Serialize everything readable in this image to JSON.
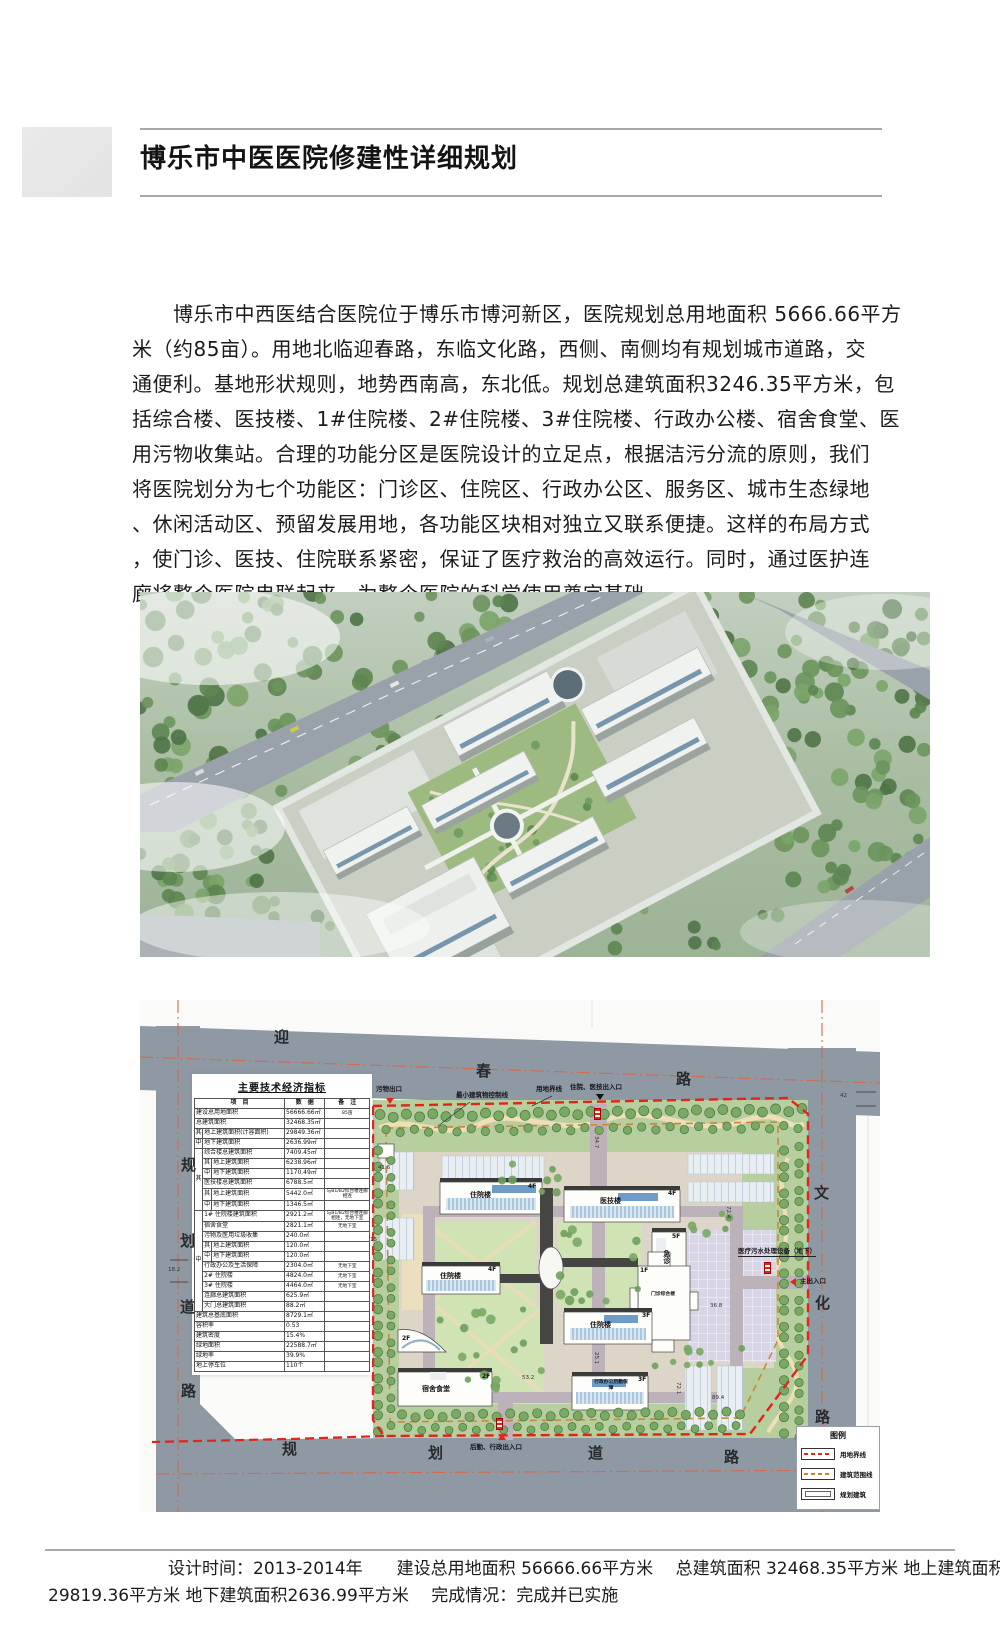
{
  "page": {
    "title": "博乐市中医医院修建性详细规划",
    "intro_lines": [
      "　　博乐市中西医结合医院位于博乐市博河新区，医院规划总用地面积 5666.66平方",
      "米（约85亩）。用地北临迎春路，东临文化路，西侧、南侧均有规划城市道路，交",
      "通便利。基地形状规则，地势西南高，东北低。规划总建筑面积3246.35平方米，包",
      "括综合楼、医技楼、1#住院楼、2#住院楼、3#住院楼、行政办公楼、宿舍食堂、医",
      "用污物收集站。合理的功能分区是医院设计的立足点，根据洁污分流的原则，我们",
      "将医院划分为七个功能区：门诊区、住院区、行政办公区、服务区、城市生态绿地",
      "、休闲活动区、预留发展用地，各功能区块相对独立又联系便捷。这样的布局方式",
      "，使门诊、医技、住院联系紧密，保证了医疗救治的高效运行。同时，通过医护连",
      "廊将整个医院串联起来，为整个医院的科学使用奠定基础。"
    ],
    "footer_lines": [
      "设计时间：2013-2014年　　建设总用地面积 56666.66平方米　 总建筑面积 32468.35平方米 地上建筑面积",
      "29819.36平方米 地下建筑面积2636.99平方米　 完成情况：完成并已实施"
    ]
  },
  "plan": {
    "roads": {
      "top": [
        "迎",
        "春",
        "路"
      ],
      "right": [
        "文",
        "化",
        "路"
      ],
      "left": [
        "规",
        "划",
        "道",
        "路"
      ],
      "bottom": [
        "规",
        "划",
        "道",
        "路"
      ]
    },
    "buildings": [
      {
        "label": "住院楼",
        "floor": "4F"
      },
      {
        "label": "医技楼",
        "floor": "4F"
      },
      {
        "label": "住院楼",
        "floor": "4F"
      },
      {
        "label": "急诊",
        "floor": "5F"
      },
      {
        "label": "门诊综合楼",
        "floor": "1F"
      },
      {
        "label": "住院楼",
        "floor": "3F"
      },
      {
        "label": "宿舍食堂",
        "floor": "2F"
      },
      {
        "label": "行政办公后勤保障",
        "floor": "3F"
      },
      {
        "label": "",
        "floor": "2F"
      }
    ],
    "annotations": {
      "waste_exit": "污物出口",
      "min_building_control_line": "最小建筑物控制线",
      "land_boundary": "用地界线",
      "inpatient_entrance": "住院、医技出入口",
      "sewage_treatment": "医疗污水处理设备（地下）",
      "main_entrance": "主出入口",
      "logistics_entrance": "后勤、行政出入口"
    },
    "dimensions": [
      "34.7",
      "41.6",
      "15",
      "18.2",
      "25.1",
      "53.2",
      "36.8",
      "72.4",
      "72.1",
      "89.4",
      "42"
    ],
    "legend": {
      "title": "图例",
      "items": [
        {
          "label": "用地界线"
        },
        {
          "label": "建筑范围线"
        },
        {
          "label": "规划建筑"
        }
      ]
    },
    "table": {
      "title": "主要技术经济指标",
      "rows": [
        [
          {
            "t": "项　目",
            "cs": 3
          },
          {
            "t": "数　据"
          },
          {
            "t": "备　注"
          }
        ],
        [
          {
            "t": "建设总用地面积",
            "cs": 3
          },
          {
            "t": "56666.66㎡"
          },
          {
            "t": "85亩"
          }
        ],
        [
          {
            "t": "总建筑面积",
            "cs": 3
          },
          {
            "t": "32468.35㎡"
          },
          {
            "t": ""
          }
        ],
        [
          {
            "t": "其"
          },
          {
            "t": "地上建筑面积(计容面积)",
            "cs": 2
          },
          {
            "t": "29849.36㎡"
          },
          {
            "t": ""
          }
        ],
        [
          {
            "t": "中"
          },
          {
            "t": "地下建筑面积",
            "cs": 2
          },
          {
            "t": "2636.99㎡"
          },
          {
            "t": ""
          }
        ],
        [
          {
            "t": "其",
            "rs": 6
          },
          {
            "t": "综合楼总建筑面积",
            "cs": 2
          },
          {
            "t": "7409.45㎡"
          },
          {
            "t": ""
          }
        ],
        [
          {
            "t": "其"
          },
          {
            "t": "地上建筑面积"
          },
          {
            "t": "6238.96㎡"
          },
          {
            "t": ""
          }
        ],
        [
          {
            "t": "中"
          },
          {
            "t": "地下建筑面积"
          },
          {
            "t": "1170.49㎡"
          },
          {
            "t": ""
          }
        ],
        [
          {
            "t": "医技楼总建筑面积",
            "cs": 2
          },
          {
            "t": "6788.5㎡"
          },
          {
            "t": ""
          }
        ],
        [
          {
            "t": "其"
          },
          {
            "t": "地上建筑面积"
          },
          {
            "t": "5442.0㎡"
          },
          {
            "t": "与B1/B2综合楼连廊相连"
          }
        ],
        [
          {
            "t": "中"
          },
          {
            "t": "地下建筑面积"
          },
          {
            "t": "1346.5㎡"
          },
          {
            "t": ""
          }
        ],
        [
          {
            "t": "中",
            "rs": 10
          },
          {
            "t": "1# 住院楼建筑面积",
            "cs": 2
          },
          {
            "t": "2921.2㎡"
          },
          {
            "t": "与B1/B2综合楼连廊相连，无地下室"
          }
        ],
        [
          {
            "t": "宿舍食堂",
            "cs": 2
          },
          {
            "t": "2821.1㎡"
          },
          {
            "t": "无地下室"
          }
        ],
        [
          {
            "t": "污物及医用垃圾收集",
            "cs": 2
          },
          {
            "t": "240.0㎡"
          },
          {
            "t": ""
          }
        ],
        [
          {
            "t": "其"
          },
          {
            "t": "地上建筑面积"
          },
          {
            "t": "120.0㎡"
          },
          {
            "t": ""
          }
        ],
        [
          {
            "t": "中"
          },
          {
            "t": "地下建筑面积"
          },
          {
            "t": "120.0㎡"
          },
          {
            "t": ""
          }
        ],
        [
          {
            "t": "行政办公及生活保障",
            "cs": 2
          },
          {
            "t": "2304.0㎡"
          },
          {
            "t": "无地下室"
          }
        ],
        [
          {
            "t": "2# 住院楼",
            "cs": 2
          },
          {
            "t": "4824.0㎡"
          },
          {
            "t": "无地下室"
          }
        ],
        [
          {
            "t": "3# 住院楼",
            "cs": 2
          },
          {
            "t": "4464.0㎡"
          },
          {
            "t": "无地下室"
          }
        ],
        [
          {
            "t": "连廊总建筑面积",
            "cs": 2
          },
          {
            "t": "625.9㎡"
          },
          {
            "t": ""
          }
        ],
        [
          {
            "t": "大门总建筑面积",
            "cs": 2
          },
          {
            "t": "88.2㎡"
          },
          {
            "t": ""
          }
        ],
        [
          {
            "t": "建筑总基底面积",
            "cs": 3
          },
          {
            "t": "8729.1㎡"
          },
          {
            "t": ""
          }
        ],
        [
          {
            "t": "容积率",
            "cs": 3
          },
          {
            "t": "0.53"
          },
          {
            "t": ""
          }
        ],
        [
          {
            "t": "建筑密度",
            "cs": 3
          },
          {
            "t": "15.4%"
          },
          {
            "t": ""
          }
        ],
        [
          {
            "t": "绿地面积",
            "cs": 3
          },
          {
            "t": "22588.7㎡"
          },
          {
            "t": ""
          }
        ],
        [
          {
            "t": "绿地率",
            "cs": 3
          },
          {
            "t": "39.9%"
          },
          {
            "t": ""
          }
        ],
        [
          {
            "t": "地上停车位",
            "cs": 3
          },
          {
            "t": "110个"
          },
          {
            "t": ""
          }
        ]
      ]
    }
  },
  "colors": {
    "boundary_red": "#e0251a",
    "control_orange": "#c8883c",
    "road_gray": "#8e99a4",
    "green_belt": "#b7cf9e"
  }
}
